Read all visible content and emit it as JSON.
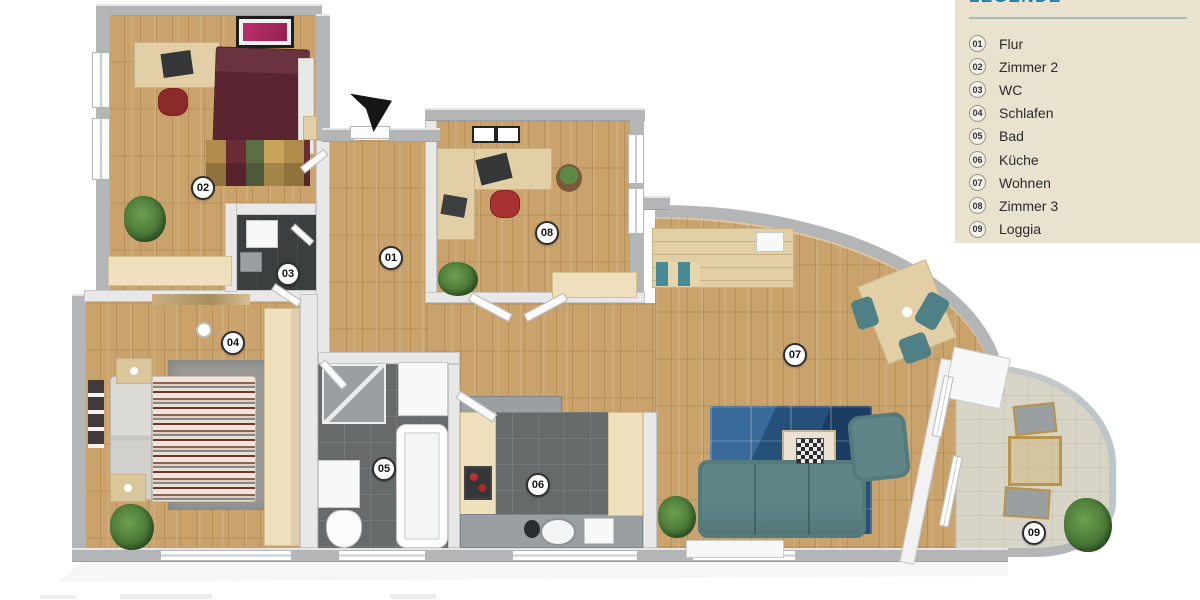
{
  "legend": {
    "title": "LEGENDE",
    "items": [
      {
        "number": "01",
        "label": "Flur"
      },
      {
        "number": "02",
        "label": "Zimmer 2"
      },
      {
        "number": "03",
        "label": "WC"
      },
      {
        "number": "04",
        "label": "Schlafen"
      },
      {
        "number": "05",
        "label": "Bad"
      },
      {
        "number": "06",
        "label": "Küche"
      },
      {
        "number": "07",
        "label": "Wohnen"
      },
      {
        "number": "08",
        "label": "Zimmer 3"
      },
      {
        "number": "09",
        "label": "Loggia"
      }
    ],
    "colors": {
      "panel_bg": "#e8e2cf",
      "title": "#1d7fa3",
      "text": "#2b2b2b"
    }
  },
  "floorplan": {
    "badges": [
      {
        "number": "01",
        "room": "Flur",
        "x": 391,
        "y": 258
      },
      {
        "number": "02",
        "room": "Zimmer 2",
        "x": 203,
        "y": 188
      },
      {
        "number": "03",
        "room": "WC",
        "x": 288,
        "y": 274
      },
      {
        "number": "04",
        "room": "Schlafen",
        "x": 233,
        "y": 343
      },
      {
        "number": "05",
        "room": "Bad",
        "x": 384,
        "y": 469
      },
      {
        "number": "06",
        "room": "Küche",
        "x": 538,
        "y": 485
      },
      {
        "number": "07",
        "room": "Wohnen",
        "x": 795,
        "y": 355
      },
      {
        "number": "08",
        "room": "Zimmer 3",
        "x": 547,
        "y": 233
      },
      {
        "number": "09",
        "room": "Loggia",
        "x": 1034,
        "y": 533
      }
    ],
    "colors": {
      "wood": "#c9a36b",
      "tile_dark": "#666a6b",
      "tile_light": "#d8d4c6",
      "wall": "#b3b5b7",
      "wall_light": "#e8e8e8",
      "rug_blue": "#24507a",
      "sofa": "#5f8588",
      "bed_dark": "#5a2531",
      "desk": "#e3cfa6",
      "accent_red": "#a83232",
      "plant": "#4d7c3a"
    }
  }
}
